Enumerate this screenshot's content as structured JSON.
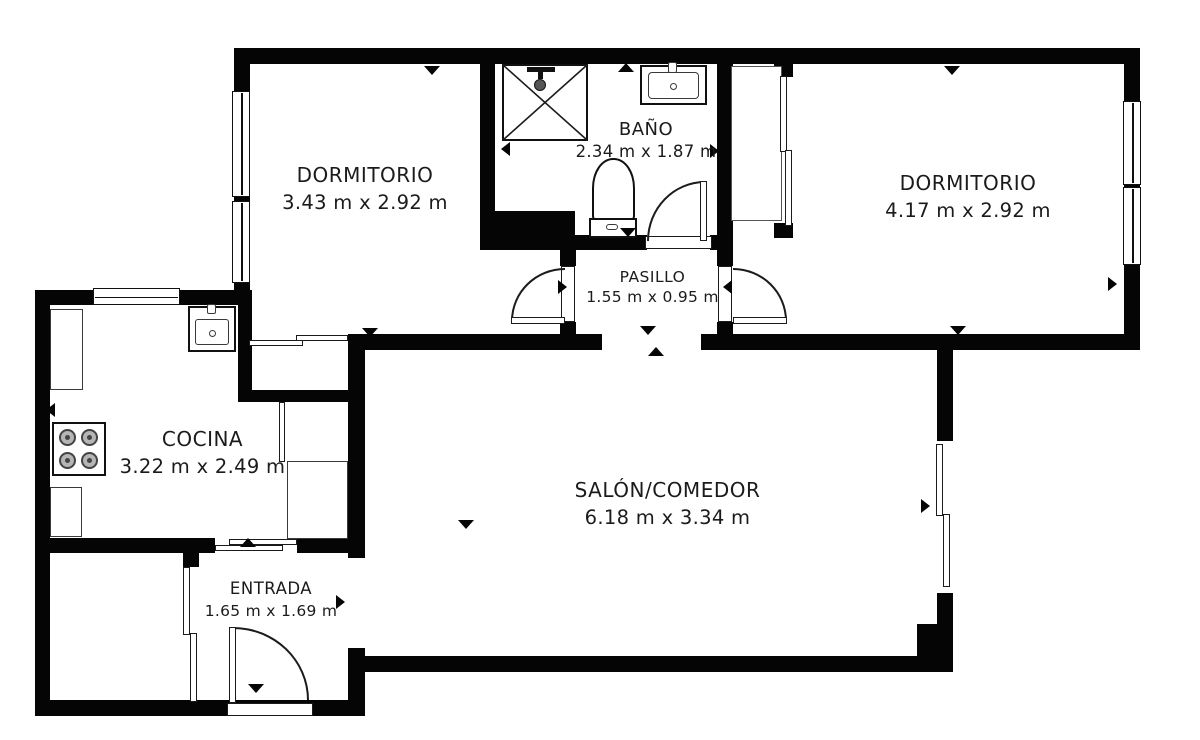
{
  "rooms": [
    {
      "id": "dormitorio-1",
      "label": "DORMITORIO",
      "dimensions": "3.43 m x 2.92 m"
    },
    {
      "id": "bano",
      "label": "BAÑO",
      "dimensions": "2.34 m x 1.87 m"
    },
    {
      "id": "dormitorio-2",
      "label": "DORMITORIO",
      "dimensions": "4.17 m x 2.92 m"
    },
    {
      "id": "pasillo",
      "label": "PASILLO",
      "dimensions": "1.55 m x 0.95 m"
    },
    {
      "id": "cocina",
      "label": "COCINA",
      "dimensions": "3.22 m x 2.49 m"
    },
    {
      "id": "salon-comedor",
      "label": "SALÓN/COMEDOR",
      "dimensions": "6.18 m x 3.34 m"
    },
    {
      "id": "entrada",
      "label": "ENTRADA",
      "dimensions": "1.65 m x 1.69 m"
    }
  ],
  "fixtures": [
    "shower",
    "washbasin",
    "toilet",
    "kitchen-sink",
    "stove",
    "countertop",
    "fridge",
    "wardrobe",
    "storage-room"
  ],
  "colors": {
    "wall": "#050505",
    "background": "#ffffff",
    "text": "#1b1b1b"
  }
}
